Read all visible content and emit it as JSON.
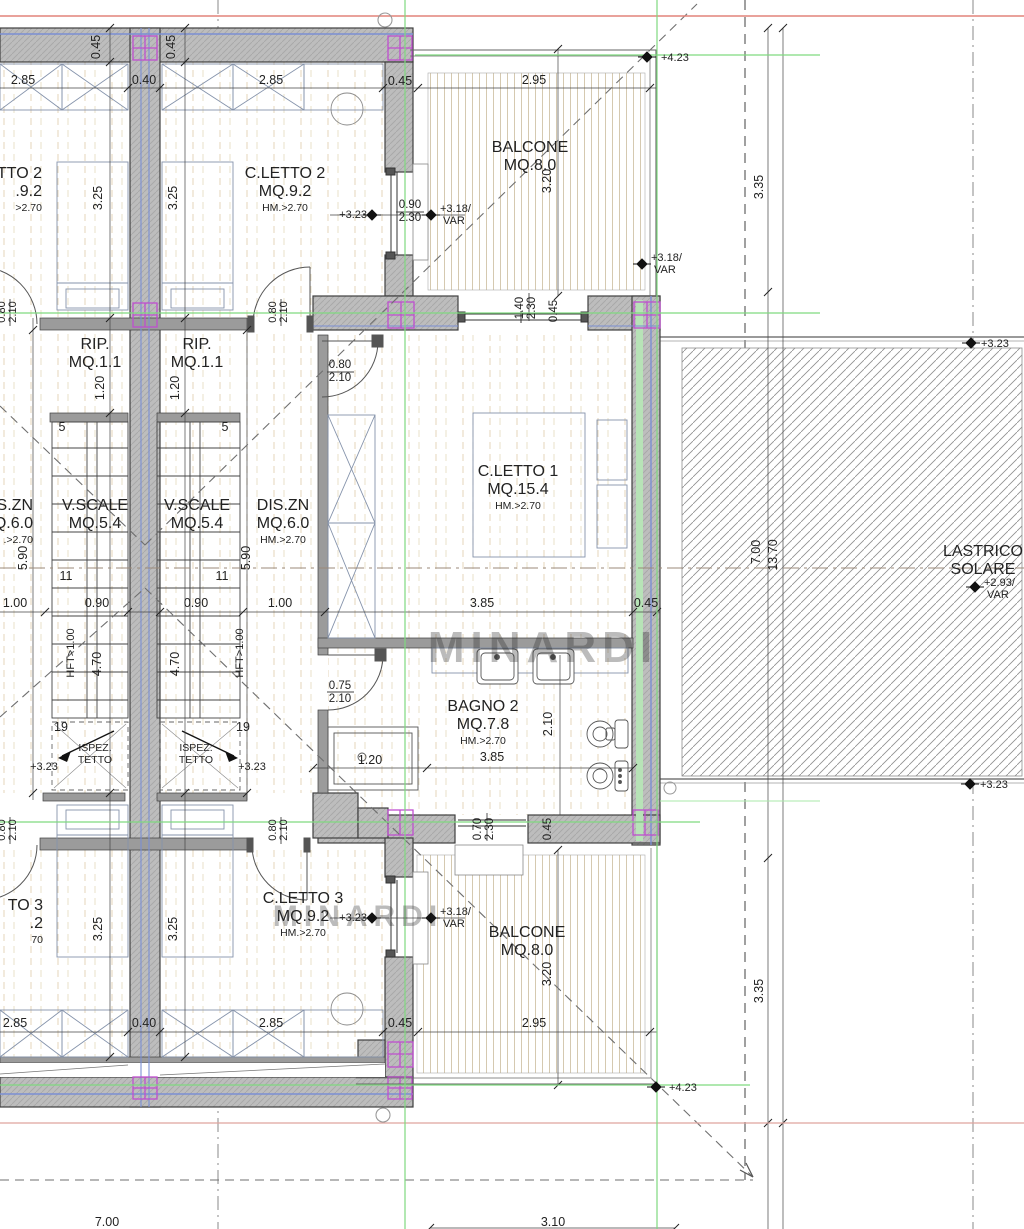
{
  "drawing_type": "architectural floor plan",
  "colors": {
    "wall_fill": "#bdbdbd",
    "wall_edge": "#3f3f3f",
    "thin_wall": "#9b9b9b",
    "blue_liner": "#7b8fd4",
    "green_liner": "#b7e3b7",
    "column_magenta": "#bf4fcf",
    "ref_red": "#e2837a",
    "ref_red2": "#dfa49e",
    "ref_green": "#7fd97f",
    "deck_stripe": "#d5c9b0",
    "grid_beige": "#dcc9a6",
    "hatch_gray": "#8f8f8f",
    "text": "#222222",
    "watermark": "#c0c0c0",
    "dim": "#2a2a2a"
  },
  "rooms": [
    {
      "id": "cletto2-right",
      "l1": "C.LETTO 2",
      "l2": "MQ.9.2",
      "l3": "HM.>2.70",
      "x": 285,
      "y": 178
    },
    {
      "id": "cletto2-left-cut",
      "l1": "TTO 2",
      "l2": ".9.2",
      "l3": ">2.70",
      "x": 42,
      "y": 178,
      "anchor": "end"
    },
    {
      "id": "balcone-top",
      "l1": "BALCONE",
      "l2": "MQ.8.0",
      "x": 530,
      "y": 152
    },
    {
      "id": "rip-left",
      "l1": "RIP.",
      "l2": "MQ.1.1",
      "x": 95,
      "y": 349
    },
    {
      "id": "rip-right",
      "l1": "RIP.",
      "l2": "MQ.1.1",
      "x": 197,
      "y": 349
    },
    {
      "id": "vscale-left",
      "l1": "V.SCALE",
      "l2": "MQ.5.4",
      "x": 95,
      "y": 510
    },
    {
      "id": "vscale-right",
      "l1": "V.SCALE",
      "l2": "MQ.5.4",
      "x": 197,
      "y": 510
    },
    {
      "id": "diszn-left-cut",
      "l1": "S.ZN",
      "l2": "Q.6.0",
      "l3": ".>2.70",
      "x": 33,
      "y": 510,
      "anchor": "end"
    },
    {
      "id": "diszn-right",
      "l1": "DIS.ZN",
      "l2": "MQ.6.0",
      "l3": "HM.>2.70",
      "x": 283,
      "y": 510
    },
    {
      "id": "cletto1",
      "l1": "C.LETTO 1",
      "l2": "MQ.15.4",
      "l3": "HM.>2.70",
      "x": 518,
      "y": 476
    },
    {
      "id": "lastrico-solare",
      "l1": "LASTRICO",
      "l2": "SOLARE",
      "x": 983,
      "y": 556
    },
    {
      "id": "ispez-tetto-left",
      "l1": "ISPEZ.",
      "l2": "TETTO",
      "x": 95,
      "y": 751,
      "small": true
    },
    {
      "id": "ispez-tetto-right",
      "l1": "ISPEZ.",
      "l2": "TETTO",
      "x": 196,
      "y": 751,
      "small": true
    },
    {
      "id": "bagno2",
      "l1": "BAGNO 2",
      "l2": "MQ.7.8",
      "l3": "HM.>2.70",
      "x": 483,
      "y": 711
    },
    {
      "id": "cletto3-right",
      "l1": "C.LETTO 3",
      "l2": "MQ.9.2",
      "l3": "HM.>2.70",
      "x": 303,
      "y": 903
    },
    {
      "id": "cletto3-left-cut",
      "l1": "TO 3",
      "l2": ".2",
      "l3": "70",
      "x": 43,
      "y": 910,
      "anchor": "end"
    },
    {
      "id": "balcone-bottom",
      "l1": "BALCONE",
      "l2": "MQ.8.0",
      "x": 527,
      "y": 937
    }
  ],
  "dimensions": [
    {
      "t": "2.85",
      "x": 23,
      "y": 84
    },
    {
      "t": "0.40",
      "x": 144,
      "y": 84
    },
    {
      "t": "2.85",
      "x": 271,
      "y": 84
    },
    {
      "t": "0.45",
      "x": 400,
      "y": 85
    },
    {
      "t": "2.95",
      "x": 534,
      "y": 84
    },
    {
      "t": "0.45",
      "x": 100,
      "y": 47,
      "r": -90
    },
    {
      "t": "0.45",
      "x": 175,
      "y": 47,
      "r": -90
    },
    {
      "t": "3.25",
      "x": 102,
      "y": 198,
      "r": -90
    },
    {
      "t": "3.25",
      "x": 177,
      "y": 198,
      "r": -90
    },
    {
      "t": "0.90",
      "x": 410,
      "y": 208,
      "s": 11.5
    },
    {
      "t": "2.30",
      "x": 410,
      "y": 221,
      "s": 11.5
    },
    {
      "t": "1.40",
      "x": 523,
      "y": 308,
      "r": -90,
      "s": 11.5
    },
    {
      "t": "2.30",
      "x": 535,
      "y": 308,
      "r": -90,
      "s": 11.5
    },
    {
      "t": "0.45",
      "x": 557,
      "y": 311,
      "r": -90,
      "s": 11.5
    },
    {
      "t": "3.20",
      "x": 551,
      "y": 181,
      "r": -90
    },
    {
      "t": "3.35",
      "x": 763,
      "y": 187,
      "r": -90
    },
    {
      "t": "0.80",
      "x": 5,
      "y": 312,
      "r": -90,
      "s": 11
    },
    {
      "t": "2.10",
      "x": 16,
      "y": 312,
      "r": -90,
      "s": 11
    },
    {
      "t": "0.80",
      "x": 276,
      "y": 312,
      "r": -90,
      "s": 11
    },
    {
      "t": "2.10",
      "x": 287,
      "y": 312,
      "r": -90,
      "s": 11
    },
    {
      "t": "0.80",
      "x": 340,
      "y": 368,
      "s": 11.5
    },
    {
      "t": "2.10",
      "x": 340,
      "y": 381,
      "s": 11.5
    },
    {
      "t": "1.20",
      "x": 104,
      "y": 388,
      "r": -90
    },
    {
      "t": "1.20",
      "x": 179,
      "y": 388,
      "r": -90
    },
    {
      "t": "5",
      "x": 62,
      "y": 431
    },
    {
      "t": "5",
      "x": 225,
      "y": 431
    },
    {
      "t": "5.90",
      "x": 27,
      "y": 558,
      "r": -90
    },
    {
      "t": "5.90",
      "x": 250,
      "y": 558,
      "r": -90
    },
    {
      "t": "11",
      "x": 66,
      "y": 580
    },
    {
      "t": "11",
      "x": 222,
      "y": 580
    },
    {
      "t": "1.00",
      "x": 15,
      "y": 607
    },
    {
      "t": "0.90",
      "x": 97,
      "y": 607
    },
    {
      "t": "0.90",
      "x": 196,
      "y": 607
    },
    {
      "t": "1.00",
      "x": 280,
      "y": 607
    },
    {
      "t": "3.85",
      "x": 482,
      "y": 607
    },
    {
      "t": "0.45",
      "x": 646,
      "y": 607
    },
    {
      "t": "HFT>1.00",
      "x": 74,
      "y": 653,
      "r": -90,
      "s": 11
    },
    {
      "t": "HFT>1.00",
      "x": 243,
      "y": 653,
      "r": -90,
      "s": 11
    },
    {
      "t": "4.70",
      "x": 101,
      "y": 664,
      "r": -90
    },
    {
      "t": "4.70",
      "x": 179,
      "y": 664,
      "r": -90
    },
    {
      "t": "0.75",
      "x": 340,
      "y": 689,
      "s": 11.5
    },
    {
      "t": "2.10",
      "x": 340,
      "y": 702,
      "s": 11.5
    },
    {
      "t": "19",
      "x": 61,
      "y": 731
    },
    {
      "t": "19",
      "x": 243,
      "y": 731
    },
    {
      "t": "1.20",
      "x": 370,
      "y": 764
    },
    {
      "t": "3.85",
      "x": 492,
      "y": 761
    },
    {
      "t": "2.10",
      "x": 552,
      "y": 724,
      "r": -90
    },
    {
      "t": "7.00",
      "x": 760,
      "y": 552,
      "r": -90
    },
    {
      "t": "13.70",
      "x": 777,
      "y": 555,
      "r": -90
    },
    {
      "t": "1.20",
      "x": 373,
      "y": 763,
      "s": 0.1
    },
    {
      "t": "0.70",
      "x": 481,
      "y": 829,
      "r": -90,
      "s": 11.5
    },
    {
      "t": "2.30",
      "x": 493,
      "y": 829,
      "r": -90,
      "s": 11.5
    },
    {
      "t": "0.45",
      "x": 551,
      "y": 829,
      "r": -90,
      "s": 11.5
    },
    {
      "t": "0.80",
      "x": 5,
      "y": 830,
      "r": -90,
      "s": 11
    },
    {
      "t": "2.10",
      "x": 16,
      "y": 830,
      "r": -90,
      "s": 11
    },
    {
      "t": "0.80",
      "x": 276,
      "y": 830,
      "r": -90,
      "s": 11
    },
    {
      "t": "2.10",
      "x": 287,
      "y": 830,
      "r": -90,
      "s": 11
    },
    {
      "t": "3.25",
      "x": 102,
      "y": 929,
      "r": -90
    },
    {
      "t": "3.25",
      "x": 177,
      "y": 929,
      "r": -90
    },
    {
      "t": "3.20",
      "x": 551,
      "y": 974,
      "r": -90
    },
    {
      "t": "3.35",
      "x": 763,
      "y": 991,
      "r": -90
    },
    {
      "t": "2.85",
      "x": 15,
      "y": 1027
    },
    {
      "t": "0.40",
      "x": 144,
      "y": 1027
    },
    {
      "t": "2.85",
      "x": 271,
      "y": 1027
    },
    {
      "t": "0.45",
      "x": 400,
      "y": 1027
    },
    {
      "t": "2.95",
      "x": 534,
      "y": 1027
    },
    {
      "t": "7.00",
      "x": 107,
      "y": 1226
    },
    {
      "t": "3.10",
      "x": 553,
      "y": 1226
    }
  ],
  "levels": [
    {
      "t": "+4.23",
      "tx": 661,
      "ty": 61,
      "dx": 647,
      "dy": 57
    },
    {
      "t": "+3.23",
      "tx": 367,
      "ty": 218,
      "dx": 372,
      "dy": 215,
      "a": "end"
    },
    {
      "t": "+3.18/",
      "t2": "VAR",
      "tx": 440,
      "ty": 212,
      "dx": 431,
      "dy": 215
    },
    {
      "t": "+3.18/",
      "t2": "VAR",
      "tx": 651,
      "ty": 261,
      "dx": 642,
      "dy": 264
    },
    {
      "t": "+3.23",
      "tx": 981,
      "ty": 347,
      "dx": 971,
      "dy": 343
    },
    {
      "t": "+2.93/",
      "t2": "VAR",
      "tx": 984,
      "ty": 586,
      "dx": 975,
      "dy": 587
    },
    {
      "t": "+3.23",
      "tx": 980,
      "ty": 788,
      "dx": 970,
      "dy": 784
    },
    {
      "t": "+3.23",
      "tx": 367,
      "ty": 921,
      "dx": 372,
      "dy": 918,
      "a": "end"
    },
    {
      "t": "+3.18/",
      "t2": "VAR",
      "tx": 440,
      "ty": 915,
      "dx": 431,
      "dy": 918
    },
    {
      "t": "+4.23",
      "tx": 669,
      "ty": 1091,
      "dx": 656,
      "dy": 1087
    },
    {
      "t": "+3.23",
      "tx": 44,
      "ty": 770,
      "a": "middle"
    },
    {
      "t": "+3.23",
      "tx": 252,
      "ty": 770,
      "a": "middle"
    }
  ],
  "watermarks": [
    {
      "t": "MINARDI",
      "x": 543,
      "y": 662,
      "s": 44
    },
    {
      "t": "MINARDI",
      "x": 358,
      "y": 926,
      "s": 30
    }
  ]
}
